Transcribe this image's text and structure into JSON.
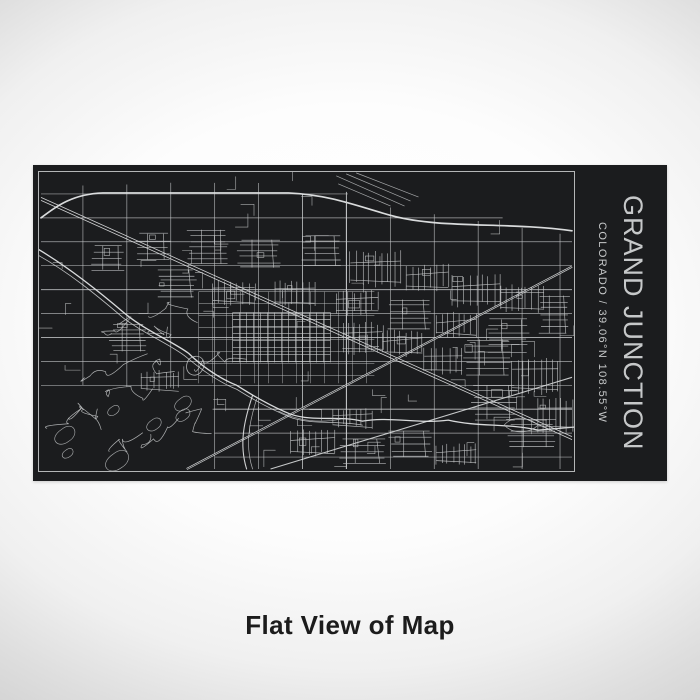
{
  "plate": {
    "title": "GRAND JUNCTION",
    "subtitle": "COLORADO / 39.06°N 108.55°W",
    "colors": {
      "plate_bg": "#1b1c1e",
      "text": "#c6c8c9",
      "frame_line": "#b4b6b7",
      "map_line": "#c7c9ca",
      "map_line_bright": "#e4e6e7"
    }
  },
  "caption": {
    "text": "Flat View of Map"
  },
  "background": {
    "center": "#ffffff",
    "edge": "#d2d2d2"
  }
}
